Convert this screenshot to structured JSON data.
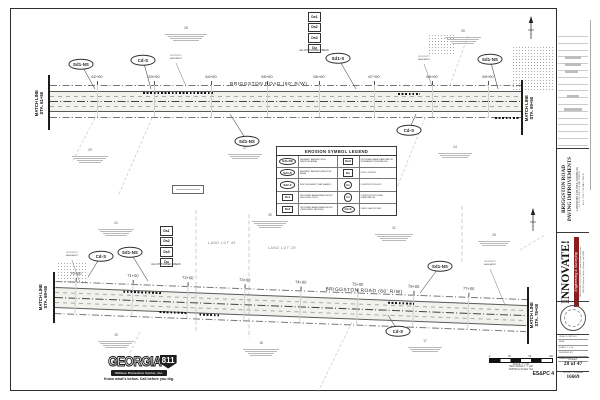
{
  "colors": {
    "line": "#3c3c3c",
    "light_line": "#9a9a9a",
    "road_fill": "#f1f1ee",
    "accent_red": "#8a1d1d",
    "ink": "#1c1c1c"
  },
  "disturbed": {
    "items": [
      "Ds1",
      "Ds2",
      "Ds3",
      "Du"
    ],
    "note": "ALL DISTURBED AREAS"
  },
  "views": {
    "top": {
      "origin": {
        "x": 50,
        "y": 101
      },
      "length": 472,
      "angle": 0,
      "name_label": {
        "text": "BRIGGSTON ROAD (60' R/W)",
        "x": 180,
        "y": -19
      },
      "match_left": {
        "lines": [
          "MATCH LINE",
          "STA. 61+50"
        ],
        "bar": {
          "x": 48,
          "y1": 75,
          "y2": 130
        },
        "cx": 39,
        "cy": 103
      },
      "match_right": {
        "lines": [
          "MATCH LINE",
          "STA. 69+50"
        ],
        "bar": {
          "x": 521,
          "y1": 80,
          "y2": 135
        },
        "cx": 529,
        "cy": 108
      },
      "stations": [
        {
          "label": "62+00",
          "x": 47
        },
        {
          "label": "63+00",
          "x": 104
        },
        {
          "label": "64+00",
          "x": 161
        },
        {
          "label": "65+00",
          "x": 217
        },
        {
          "label": "66+00",
          "x": 269
        },
        {
          "label": "67+00",
          "x": 324
        },
        {
          "label": "68+00",
          "x": 382
        },
        {
          "label": "69+00",
          "x": 438
        }
      ],
      "strips": [
        {
          "x": 93,
          "y": -9,
          "w": 72
        },
        {
          "x": 348,
          "y": -8,
          "w": 22
        },
        {
          "x": 445,
          "y": 16,
          "w": 25
        }
      ],
      "callouts": [
        {
          "label": "Sd1-NS",
          "x": 81,
          "y": 64,
          "tx": 95,
          "ty": 89
        },
        {
          "label": "Cd-S",
          "x": 143,
          "y": 60,
          "tx": 151,
          "ty": 89
        },
        {
          "label": "Sd1-S",
          "x": 338,
          "y": 58,
          "tx": 356,
          "ty": 89
        },
        {
          "label": "Sd1-NS",
          "x": 490,
          "y": 59,
          "tx": 498,
          "ty": 89
        },
        {
          "label": "Sd1-NS",
          "x": 247,
          "y": 141,
          "tx": 230,
          "ty": 114
        },
        {
          "label": "Cd-S",
          "x": 409,
          "y": 130,
          "tx": 416,
          "ty": 114
        }
      ],
      "easement_text": "20' UTILITY\nEASEMENT",
      "easements": [
        {
          "x": 176,
          "y": 58,
          "tx": 186,
          "ty": 86
        },
        {
          "x": 424,
          "y": 59,
          "tx": 432,
          "ty": 86
        }
      ],
      "stack": {
        "x": 308,
        "y": 12
      },
      "notes": [
        {
          "x": 165,
          "y": 33,
          "w": 42,
          "l": 4,
          "num": "28"
        },
        {
          "x": 445,
          "y": 36,
          "w": 36,
          "l": 4,
          "num": "26"
        },
        {
          "x": 72,
          "y": 155,
          "w": 36,
          "l": 4,
          "num": "29"
        },
        {
          "x": 228,
          "y": 153,
          "w": 34,
          "l": 3,
          "num": "27"
        },
        {
          "x": 438,
          "y": 152,
          "w": 34,
          "l": 3,
          "num": "24"
        }
      ],
      "note_box": {
        "x": 172,
        "y": 185,
        "w": 30,
        "h": 7
      },
      "stipples": [
        {
          "x": 512,
          "y": 46,
          "w": 42,
          "h": 46
        },
        {
          "x": 428,
          "y": 34,
          "w": 28,
          "h": 22
        }
      ],
      "diagonals": [
        [
          152,
          118,
          118,
          196
        ],
        [
          425,
          118,
          392,
          200
        ],
        [
          468,
          36,
          450,
          85
        ],
        [
          95,
          118,
          72,
          162
        ]
      ],
      "lot_lines": [],
      "land_lots": [],
      "north": {
        "x": 531,
        "y": 16
      }
    },
    "bottom": {
      "origin": {
        "x": 55,
        "y": 297
      },
      "length": 472,
      "angle": 2.2,
      "name_label": {
        "text": "BRIGGSTON ROAD (60' R/W)",
        "x": 270,
        "y": -20
      },
      "match_left": {
        "lines": [
          "MATCH LINE",
          "STA. 69+50"
        ],
        "bar": {
          "x": 53,
          "y1": 272,
          "y2": 323
        },
        "cx": 43,
        "cy": 297
      },
      "match_right": {
        "lines": [
          "MATCH LINE",
          "STA. 78+00"
        ],
        "bar": {
          "x": 527,
          "y1": 287,
          "y2": 344
        },
        "cx": 534,
        "cy": 315
      },
      "stations": [
        {
          "label": "70+00",
          "x": 20
        },
        {
          "label": "71+00",
          "x": 77
        },
        {
          "label": "72+00",
          "x": 132
        },
        {
          "label": "73+00",
          "x": 189
        },
        {
          "label": "74+00",
          "x": 245
        },
        {
          "label": "75+00",
          "x": 302
        },
        {
          "label": "76+00",
          "x": 358
        },
        {
          "label": "77+00",
          "x": 413
        }
      ],
      "strips": [
        {
          "x": 68,
          "y": -9,
          "w": 38
        },
        {
          "x": 333,
          "y": -8,
          "w": 26
        },
        {
          "x": 105,
          "y": 10,
          "w": 27
        },
        {
          "x": 145,
          "y": 11,
          "w": 20
        }
      ],
      "callouts": [
        {
          "label": "Cd-S",
          "x": 101,
          "y": 256,
          "tx": 88,
          "ty": 277
        },
        {
          "label": "Sd1-NS",
          "x": 130,
          "y": 252,
          "tx": 148,
          "ty": 281
        },
        {
          "label": "Sd1-NS",
          "x": 440,
          "y": 266,
          "tx": 420,
          "ty": 293
        },
        {
          "label": "Cd-S",
          "x": 398,
          "y": 331,
          "tx": 388,
          "ty": 315
        }
      ],
      "easement_text": "20' UTILITY\nEASEMENT",
      "easements": [
        {
          "x": 72,
          "y": 255,
          "tx": 80,
          "ty": 283
        },
        {
          "x": 490,
          "y": 264,
          "tx": 505,
          "ty": 305
        }
      ],
      "stack": {
        "x": 160,
        "y": 226
      },
      "notes": [
        {
          "x": 98,
          "y": 228,
          "w": 36,
          "l": 4,
          "num": "21"
        },
        {
          "x": 252,
          "y": 220,
          "w": 36,
          "l": 4,
          "num": "30"
        },
        {
          "x": 375,
          "y": 233,
          "w": 38,
          "l": 4,
          "num": "31"
        },
        {
          "x": 478,
          "y": 240,
          "w": 32,
          "l": 3,
          "num": "25"
        },
        {
          "x": 98,
          "y": 340,
          "w": 36,
          "l": 4,
          "num": "19"
        },
        {
          "x": 243,
          "y": 348,
          "w": 36,
          "l": 4,
          "num": "18"
        },
        {
          "x": 408,
          "y": 346,
          "w": 34,
          "l": 3,
          "num": "17"
        }
      ],
      "note_box": null,
      "stipples": [
        {
          "x": 57,
          "y": 262,
          "w": 30,
          "h": 22
        }
      ],
      "diagonals": [
        [
          352,
          322,
          318,
          392
        ],
        [
          140,
          332,
          112,
          390
        ],
        [
          520,
          250,
          545,
          235
        ]
      ],
      "lot_lines": [
        [
          196,
          210,
          196,
          332
        ],
        [
          249,
          214,
          249,
          338
        ],
        [
          462,
          206,
          462,
          262
        ]
      ],
      "land_lots": [
        {
          "text": "LAND LOT 45",
          "x": 208,
          "y": 241
        },
        {
          "text": "LAND LOT 28",
          "x": 268,
          "y": 246
        }
      ],
      "north": {
        "x": 533,
        "y": 208
      }
    }
  },
  "legend": {
    "title": "EROSION SYMBOL LEGEND",
    "rows": [
      {
        "l_sym": "Sd1-NS",
        "l_shape": "oval",
        "l_desc": "SEDIMENT BARRIER (NON-SENSITIVE AREA)",
        "r_sym": "Ds3",
        "r_shape": "box",
        "r_desc": "DISTURBED AREA STABILIZATION (PERMANENT VEGETATION)"
      },
      {
        "l_sym": "Sd1-S",
        "l_shape": "oval",
        "l_desc": "SEDIMENT BARRIER (SENSITIVE AREA)",
        "r_sym": "Du",
        "r_shape": "box",
        "r_desc": "DUST CONTROL"
      },
      {
        "l_sym": "Sd2-F",
        "l_shape": "oval",
        "l_desc": "INLET SEDIMENT TRAP (FABRIC)",
        "r_sym": "Co",
        "r_shape": "circle",
        "r_desc": "CONSTRUCTION EXIT"
      },
      {
        "l_sym": "Ds1",
        "l_shape": "box",
        "l_desc": "DISTURBED AREA STABILIZATION (MULCHING ONLY)",
        "r_sym": "Cs",
        "r_shape": "circle",
        "r_desc": "CONSTRUCTION ROAD STABILIZATION"
      },
      {
        "l_sym": "Ds2",
        "l_shape": "box",
        "l_desc": "DISTURBED AREA STABILIZATION (TEMPORARY SEEDING)",
        "r_sym": "Cd-S",
        "r_shape": "oval",
        "r_desc": "CHECK DAM (STONE)"
      }
    ]
  },
  "georgia811": {
    "word": "GEORGIA",
    "number": "811",
    "bar_text": "Utilities Protection Center, Inc.",
    "tagline": "Know what's below. Call before you dig."
  },
  "title_block": {
    "project_lines": [
      "BRIGGSTON ROAD",
      "PAVING IMPROVEMENTS",
      "LOWNDES COUNTY, GEORGIA",
      "L.L. 20, 29, 30 & 31 OF THE 16TH L.D.",
      "& L.L. 76 & 77 OF THE 11TH L.D."
    ],
    "firm": {
      "name": "INNOVATE!",
      "tagline": "Engineering & Surveying",
      "line1": "TELEPHONE (229) 244-0594  •  www.innovate-eng.com",
      "line2": "2804 N. Patterson Street, Valdosta, GA 31602"
    },
    "info_rows": [
      "LEVEL II CERT. NO.",
      "DATE:",
      "SCALE: 1\" = 50'",
      "DESIGNED BY:",
      "DRAWN BY:",
      "CHECKED BY:"
    ],
    "sheet_label": "SHEET",
    "sheet_value": "28 of 47",
    "project_label": "PROJECT NUMBER",
    "project_value": "16669"
  },
  "scale_bar": {
    "tick_labels": [
      "0",
      "25",
      "50",
      "100"
    ],
    "lines": [
      "SCALE: 1\" = 50'",
      "HALF SCALE: 1\" = 100'",
      "VERTICAL SCALE: N/A"
    ],
    "series_label": "ES&PC 4"
  }
}
